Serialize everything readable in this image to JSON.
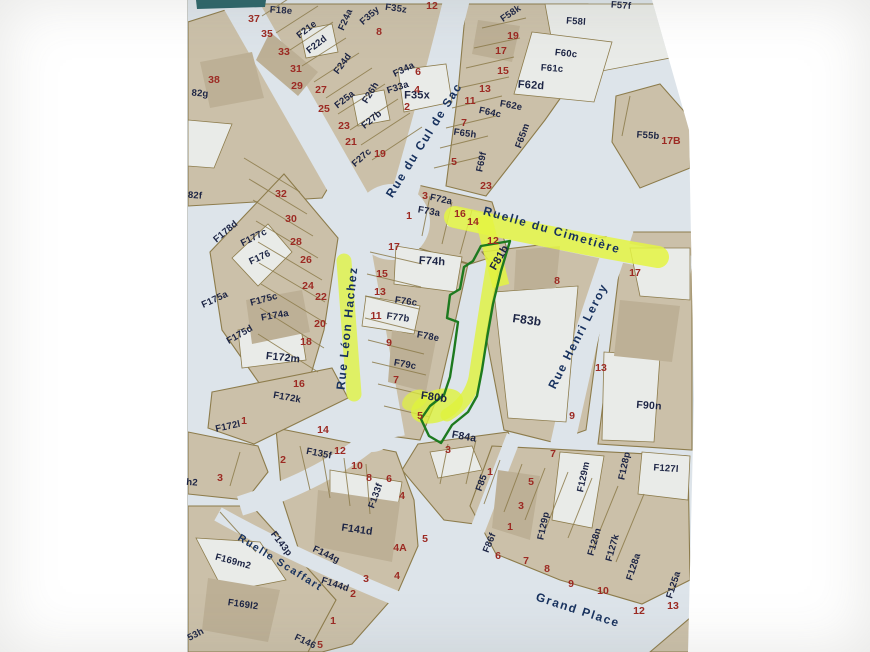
{
  "map": {
    "colors": {
      "parcel_fill": "#cbc0a9",
      "building_fill": "#bdb096",
      "light_parcel_fill": "#e9ebe8",
      "street_fill": "#dde4ea",
      "boundary_line": "#8d7c4c",
      "house_number_text": "#9c2a23",
      "parcel_code_text": "#1c2444",
      "street_name_text": "#17315e",
      "highlighter_yellow": "#e4f542",
      "subject_parcel_outline": "#1d7a1f",
      "header_strip_teal": "#2a6468"
    },
    "highlights": {
      "subject_parcel_codes": [
        "F81b",
        "F80b"
      ],
      "highlighted_streets": [
        "Ruelle du Cimetière",
        "Rue Léon Hachez"
      ]
    },
    "street_names": [
      "Rue du Cul de Sac",
      "Ruelle du Cimetière",
      "Rue Léon Hachez",
      "Rue Henri Leroy",
      "Ruelle Scaffart",
      "Grand Place"
    ],
    "labels": [
      {
        "t": "Rue du Cul de Sac",
        "x": 424,
        "y": 140,
        "r": -58,
        "k": "street"
      },
      {
        "t": "Ruelle du Cimetière",
        "x": 552,
        "y": 230,
        "r": 16,
        "k": "street",
        "hl": true
      },
      {
        "t": "Rue Léon Hachez",
        "x": 347,
        "y": 328,
        "r": -84,
        "k": "street",
        "hl": true
      },
      {
        "t": "Rue Henri Leroy",
        "x": 578,
        "y": 336,
        "r": -63,
        "k": "street"
      },
      {
        "t": "Ruelle Scaffart",
        "x": 280,
        "y": 563,
        "r": 32,
        "k": "street",
        "s": 10.5
      },
      {
        "t": "Grand Place",
        "x": 578,
        "y": 610,
        "r": 18,
        "k": "street"
      },
      {
        "t": "F18e",
        "x": 281,
        "y": 11,
        "r": 4,
        "k": "code"
      },
      {
        "t": "F21e",
        "x": 307,
        "y": 30,
        "r": -38,
        "k": "code"
      },
      {
        "t": "F22d",
        "x": 317,
        "y": 45,
        "r": -38,
        "k": "code"
      },
      {
        "t": "F24a",
        "x": 346,
        "y": 20,
        "r": -66,
        "k": "code"
      },
      {
        "t": "F35y",
        "x": 370,
        "y": 16,
        "r": -42,
        "k": "code"
      },
      {
        "t": "F35z",
        "x": 396,
        "y": 9,
        "r": 8,
        "k": "code"
      },
      {
        "t": "F35x",
        "x": 417,
        "y": 96,
        "r": 0,
        "k": "code",
        "s": 11
      },
      {
        "t": "F34a",
        "x": 404,
        "y": 70,
        "r": -26,
        "k": "code"
      },
      {
        "t": "F33a",
        "x": 398,
        "y": 88,
        "r": -18,
        "k": "code"
      },
      {
        "t": "F24d",
        "x": 343,
        "y": 64,
        "r": -54,
        "k": "code"
      },
      {
        "t": "F25a",
        "x": 345,
        "y": 100,
        "r": -38,
        "k": "code"
      },
      {
        "t": "F26h",
        "x": 371,
        "y": 93,
        "r": -58,
        "k": "code"
      },
      {
        "t": "F27b",
        "x": 372,
        "y": 120,
        "r": -40,
        "k": "code"
      },
      {
        "t": "F27c",
        "x": 362,
        "y": 158,
        "r": -42,
        "k": "code"
      },
      {
        "t": "F58k",
        "x": 511,
        "y": 14,
        "r": -34,
        "k": "code"
      },
      {
        "t": "F58l",
        "x": 576,
        "y": 22,
        "r": 4,
        "k": "code"
      },
      {
        "t": "F57f",
        "x": 621,
        "y": 6,
        "r": 4,
        "k": "code"
      },
      {
        "t": "F60c",
        "x": 566,
        "y": 54,
        "r": 6,
        "k": "code"
      },
      {
        "t": "F61c",
        "x": 552,
        "y": 69,
        "r": 4,
        "k": "code"
      },
      {
        "t": "F62d",
        "x": 531,
        "y": 86,
        "r": 4,
        "k": "code",
        "s": 11
      },
      {
        "t": "F62e",
        "x": 511,
        "y": 106,
        "r": 10,
        "k": "code"
      },
      {
        "t": "F64c",
        "x": 490,
        "y": 113,
        "r": 12,
        "k": "code"
      },
      {
        "t": "F65h",
        "x": 465,
        "y": 134,
        "r": 8,
        "k": "code"
      },
      {
        "t": "F65m",
        "x": 523,
        "y": 136,
        "r": -70,
        "k": "code"
      },
      {
        "t": "F69f",
        "x": 482,
        "y": 162,
        "r": -78,
        "k": "code"
      },
      {
        "t": "F55b",
        "x": 648,
        "y": 136,
        "r": 4,
        "k": "code"
      },
      {
        "t": "82g",
        "x": 200,
        "y": 94,
        "r": 4,
        "k": "code"
      },
      {
        "t": "82f",
        "x": 195,
        "y": 196,
        "r": 4,
        "k": "code"
      },
      {
        "t": "F178d",
        "x": 226,
        "y": 232,
        "r": -40,
        "k": "code"
      },
      {
        "t": "F177c",
        "x": 254,
        "y": 238,
        "r": -27,
        "k": "code"
      },
      {
        "t": "F176",
        "x": 260,
        "y": 258,
        "r": -25,
        "k": "code"
      },
      {
        "t": "F175a",
        "x": 215,
        "y": 300,
        "r": -25,
        "k": "code"
      },
      {
        "t": "F175c",
        "x": 264,
        "y": 300,
        "r": -15,
        "k": "code"
      },
      {
        "t": "F174a",
        "x": 275,
        "y": 316,
        "r": -10,
        "k": "code"
      },
      {
        "t": "F175d",
        "x": 240,
        "y": 335,
        "r": -30,
        "k": "code"
      },
      {
        "t": "F172m",
        "x": 283,
        "y": 358,
        "r": 6,
        "k": "code",
        "s": 10.5
      },
      {
        "t": "F172k",
        "x": 287,
        "y": 398,
        "r": 10,
        "k": "code"
      },
      {
        "t": "F172l",
        "x": 228,
        "y": 427,
        "r": -12,
        "k": "code"
      },
      {
        "t": "h2",
        "x": 192,
        "y": 483,
        "r": 4,
        "k": "code"
      },
      {
        "t": "F72a",
        "x": 441,
        "y": 200,
        "r": 12,
        "k": "code"
      },
      {
        "t": "F73a",
        "x": 429,
        "y": 212,
        "r": 10,
        "k": "code"
      },
      {
        "t": "F74h",
        "x": 432,
        "y": 262,
        "r": 4,
        "k": "code",
        "s": 11
      },
      {
        "t": "F76c",
        "x": 406,
        "y": 302,
        "r": 8,
        "k": "code"
      },
      {
        "t": "F77b",
        "x": 398,
        "y": 318,
        "r": 8,
        "k": "code"
      },
      {
        "t": "F78e",
        "x": 428,
        "y": 337,
        "r": 10,
        "k": "code"
      },
      {
        "t": "F79c",
        "x": 405,
        "y": 365,
        "r": 10,
        "k": "code"
      },
      {
        "t": "F80b",
        "x": 434,
        "y": 398,
        "r": 8,
        "k": "code",
        "s": 11,
        "hl": true
      },
      {
        "t": "F81b",
        "x": 500,
        "y": 258,
        "r": -60,
        "k": "code",
        "s": 11,
        "hl": true
      },
      {
        "t": "F83b",
        "x": 527,
        "y": 320,
        "r": 8,
        "k": "code",
        "s": 12
      },
      {
        "t": "F84a",
        "x": 464,
        "y": 437,
        "r": 10,
        "k": "code",
        "s": 10.5
      },
      {
        "t": "F85",
        "x": 482,
        "y": 483,
        "r": -70,
        "k": "code"
      },
      {
        "t": "F86f",
        "x": 490,
        "y": 543,
        "r": -68,
        "k": "code"
      },
      {
        "t": "F90n",
        "x": 649,
        "y": 406,
        "r": 4,
        "k": "code",
        "s": 10.5
      },
      {
        "t": "F129m",
        "x": 584,
        "y": 477,
        "r": -78,
        "k": "code"
      },
      {
        "t": "F129p",
        "x": 544,
        "y": 526,
        "r": -78,
        "k": "code"
      },
      {
        "t": "F128p",
        "x": 625,
        "y": 466,
        "r": -78,
        "k": "code"
      },
      {
        "t": "F127l",
        "x": 666,
        "y": 469,
        "r": 4,
        "k": "code"
      },
      {
        "t": "F128n",
        "x": 595,
        "y": 542,
        "r": -74,
        "k": "code"
      },
      {
        "t": "F127k",
        "x": 613,
        "y": 548,
        "r": -74,
        "k": "code"
      },
      {
        "t": "F128a",
        "x": 634,
        "y": 567,
        "r": -72,
        "k": "code"
      },
      {
        "t": "F125a",
        "x": 674,
        "y": 585,
        "r": -72,
        "k": "code"
      },
      {
        "t": "F133f",
        "x": 376,
        "y": 496,
        "r": -70,
        "k": "code"
      },
      {
        "t": "F135f",
        "x": 319,
        "y": 454,
        "r": 11,
        "k": "code"
      },
      {
        "t": "F141d",
        "x": 357,
        "y": 530,
        "r": 8,
        "k": "code",
        "s": 10.5
      },
      {
        "t": "F143p",
        "x": 281,
        "y": 544,
        "r": 52,
        "k": "code"
      },
      {
        "t": "F144g",
        "x": 326,
        "y": 555,
        "r": 25,
        "k": "code"
      },
      {
        "t": "F144d",
        "x": 335,
        "y": 585,
        "r": 18,
        "k": "code"
      },
      {
        "t": "F146",
        "x": 305,
        "y": 642,
        "r": 25,
        "k": "code"
      },
      {
        "t": "F169m2",
        "x": 233,
        "y": 562,
        "r": 15,
        "k": "code"
      },
      {
        "t": "F169l2",
        "x": 243,
        "y": 605,
        "r": 8,
        "k": "code"
      },
      {
        "t": "53h",
        "x": 196,
        "y": 635,
        "r": -28,
        "k": "code"
      },
      {
        "t": "37",
        "x": 254,
        "y": 19,
        "k": "num"
      },
      {
        "t": "35",
        "x": 267,
        "y": 34,
        "k": "num"
      },
      {
        "t": "33",
        "x": 284,
        "y": 52,
        "k": "num"
      },
      {
        "t": "31",
        "x": 296,
        "y": 69,
        "k": "num"
      },
      {
        "t": "29",
        "x": 297,
        "y": 86,
        "k": "num"
      },
      {
        "t": "27",
        "x": 321,
        "y": 90,
        "k": "num"
      },
      {
        "t": "25",
        "x": 324,
        "y": 109,
        "k": "num"
      },
      {
        "t": "23",
        "x": 344,
        "y": 126,
        "k": "num"
      },
      {
        "t": "21",
        "x": 351,
        "y": 142,
        "k": "num"
      },
      {
        "t": "19",
        "x": 380,
        "y": 154,
        "k": "num"
      },
      {
        "t": "38",
        "x": 214,
        "y": 80,
        "k": "num"
      },
      {
        "t": "8",
        "x": 379,
        "y": 32,
        "k": "num"
      },
      {
        "t": "12",
        "x": 432,
        "y": 6,
        "k": "num"
      },
      {
        "t": "6",
        "x": 418,
        "y": 72,
        "k": "num"
      },
      {
        "t": "4",
        "x": 417,
        "y": 90,
        "k": "num"
      },
      {
        "t": "2",
        "x": 407,
        "y": 107,
        "k": "num"
      },
      {
        "t": "19",
        "x": 513,
        "y": 36,
        "k": "num"
      },
      {
        "t": "17",
        "x": 501,
        "y": 51,
        "k": "num"
      },
      {
        "t": "15",
        "x": 503,
        "y": 71,
        "k": "num"
      },
      {
        "t": "13",
        "x": 485,
        "y": 89,
        "k": "num"
      },
      {
        "t": "11",
        "x": 470,
        "y": 101,
        "k": "num"
      },
      {
        "t": "7",
        "x": 464,
        "y": 123,
        "k": "num"
      },
      {
        "t": "5",
        "x": 454,
        "y": 162,
        "k": "num"
      },
      {
        "t": "17B",
        "x": 671,
        "y": 141,
        "k": "num"
      },
      {
        "t": "32",
        "x": 281,
        "y": 194,
        "k": "num"
      },
      {
        "t": "30",
        "x": 291,
        "y": 219,
        "k": "num"
      },
      {
        "t": "28",
        "x": 296,
        "y": 242,
        "k": "num"
      },
      {
        "t": "26",
        "x": 306,
        "y": 260,
        "k": "num"
      },
      {
        "t": "24",
        "x": 308,
        "y": 286,
        "k": "num"
      },
      {
        "t": "22",
        "x": 321,
        "y": 297,
        "k": "num"
      },
      {
        "t": "20",
        "x": 320,
        "y": 324,
        "k": "num"
      },
      {
        "t": "18",
        "x": 306,
        "y": 342,
        "k": "num"
      },
      {
        "t": "16",
        "x": 299,
        "y": 384,
        "k": "num"
      },
      {
        "t": "17",
        "x": 394,
        "y": 247,
        "k": "num"
      },
      {
        "t": "15",
        "x": 382,
        "y": 274,
        "k": "num"
      },
      {
        "t": "13",
        "x": 380,
        "y": 292,
        "k": "num"
      },
      {
        "t": "11",
        "x": 376,
        "y": 316,
        "k": "num"
      },
      {
        "t": "9",
        "x": 389,
        "y": 343,
        "k": "num"
      },
      {
        "t": "7",
        "x": 396,
        "y": 380,
        "k": "num"
      },
      {
        "t": "5",
        "x": 420,
        "y": 416,
        "k": "num"
      },
      {
        "t": "3",
        "x": 425,
        "y": 196,
        "k": "num"
      },
      {
        "t": "1",
        "x": 409,
        "y": 216,
        "k": "num"
      },
      {
        "t": "16",
        "x": 460,
        "y": 214,
        "k": "num"
      },
      {
        "t": "14",
        "x": 473,
        "y": 222,
        "k": "num"
      },
      {
        "t": "23",
        "x": 486,
        "y": 186,
        "k": "num"
      },
      {
        "t": "12",
        "x": 493,
        "y": 241,
        "k": "num"
      },
      {
        "t": "8",
        "x": 557,
        "y": 281,
        "k": "num"
      },
      {
        "t": "17",
        "x": 635,
        "y": 273,
        "k": "num"
      },
      {
        "t": "13",
        "x": 601,
        "y": 368,
        "k": "num"
      },
      {
        "t": "9",
        "x": 572,
        "y": 416,
        "k": "num"
      },
      {
        "t": "3",
        "x": 448,
        "y": 450,
        "k": "num"
      },
      {
        "t": "1",
        "x": 490,
        "y": 472,
        "k": "num"
      },
      {
        "t": "1",
        "x": 244,
        "y": 421,
        "k": "num"
      },
      {
        "t": "2",
        "x": 283,
        "y": 460,
        "k": "num"
      },
      {
        "t": "3",
        "x": 220,
        "y": 478,
        "k": "num"
      },
      {
        "t": "14",
        "x": 323,
        "y": 430,
        "k": "num"
      },
      {
        "t": "12",
        "x": 340,
        "y": 451,
        "k": "num"
      },
      {
        "t": "10",
        "x": 357,
        "y": 466,
        "k": "num"
      },
      {
        "t": "8",
        "x": 369,
        "y": 478,
        "k": "num"
      },
      {
        "t": "6",
        "x": 389,
        "y": 479,
        "k": "num"
      },
      {
        "t": "4",
        "x": 402,
        "y": 496,
        "k": "num"
      },
      {
        "t": "4A",
        "x": 400,
        "y": 548,
        "k": "num"
      },
      {
        "t": "5",
        "x": 425,
        "y": 539,
        "k": "num"
      },
      {
        "t": "3",
        "x": 366,
        "y": 579,
        "k": "num"
      },
      {
        "t": "4",
        "x": 397,
        "y": 576,
        "k": "num"
      },
      {
        "t": "2",
        "x": 353,
        "y": 594,
        "k": "num"
      },
      {
        "t": "1",
        "x": 333,
        "y": 621,
        "k": "num"
      },
      {
        "t": "5",
        "x": 320,
        "y": 645,
        "k": "num"
      },
      {
        "t": "7",
        "x": 553,
        "y": 454,
        "k": "num"
      },
      {
        "t": "5",
        "x": 531,
        "y": 482,
        "k": "num"
      },
      {
        "t": "3",
        "x": 521,
        "y": 506,
        "k": "num"
      },
      {
        "t": "1",
        "x": 510,
        "y": 527,
        "k": "num"
      },
      {
        "t": "6",
        "x": 498,
        "y": 556,
        "k": "num"
      },
      {
        "t": "7",
        "x": 526,
        "y": 561,
        "k": "num"
      },
      {
        "t": "8",
        "x": 547,
        "y": 569,
        "k": "num"
      },
      {
        "t": "9",
        "x": 571,
        "y": 584,
        "k": "num"
      },
      {
        "t": "10",
        "x": 603,
        "y": 591,
        "k": "num"
      },
      {
        "t": "12",
        "x": 639,
        "y": 611,
        "k": "num"
      },
      {
        "t": "13",
        "x": 673,
        "y": 606,
        "k": "num"
      }
    ]
  }
}
